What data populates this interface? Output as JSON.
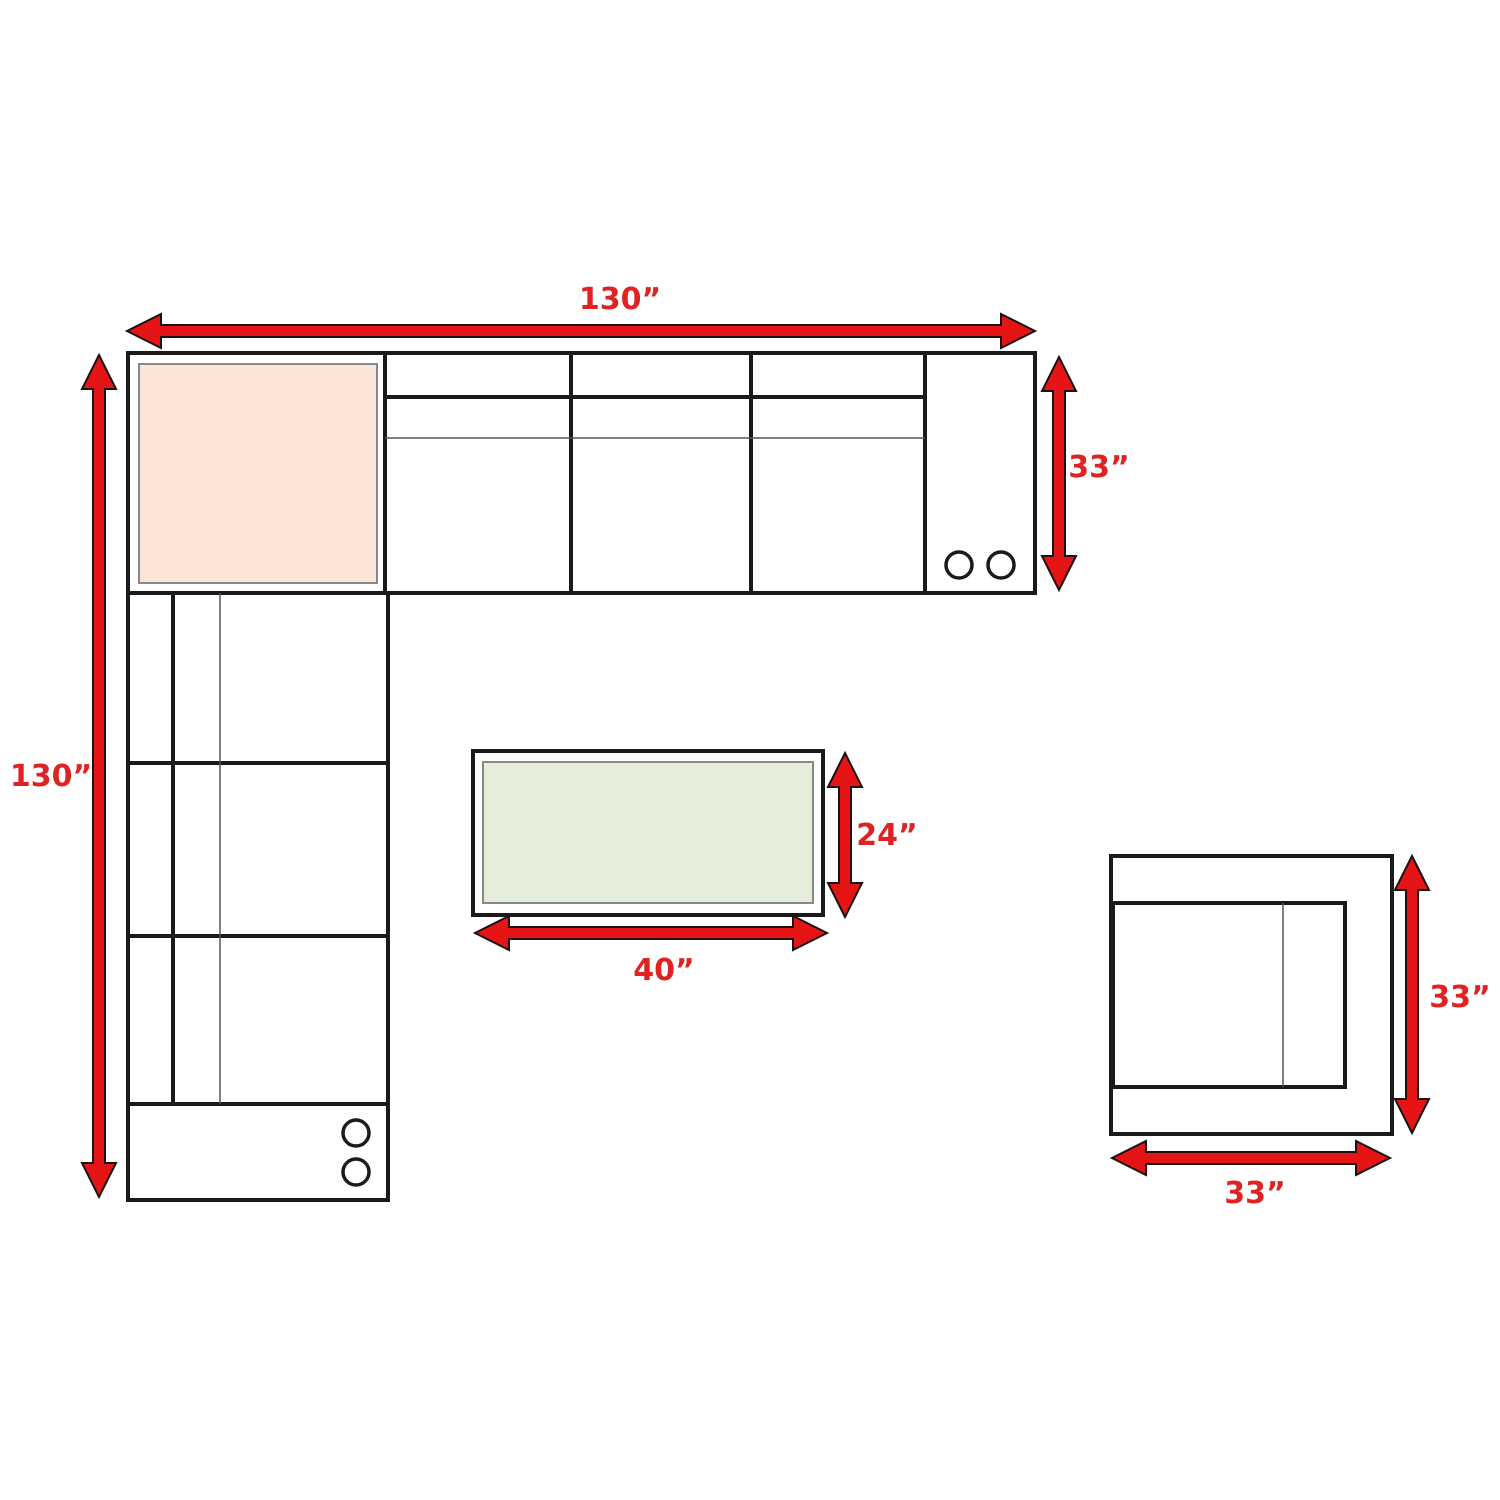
{
  "diagram": {
    "type": "furniture-floorplan-dimension-diagram",
    "colors": {
      "arrow_red": "#e51515",
      "label_red": "#e02222",
      "outline_black": "#1a1a1a",
      "corner_piece_fill": "#fbe5d9",
      "table_top_fill": "#e4eeda",
      "inset_border_gray": "#888888"
    },
    "sectional": {
      "width_label": "130”",
      "height_label": "130”",
      "depth_label": "33”"
    },
    "coffee_table": {
      "width_label": "40”",
      "depth_label": "24”"
    },
    "chair": {
      "depth_label": "33”",
      "width_label": "33”"
    }
  }
}
